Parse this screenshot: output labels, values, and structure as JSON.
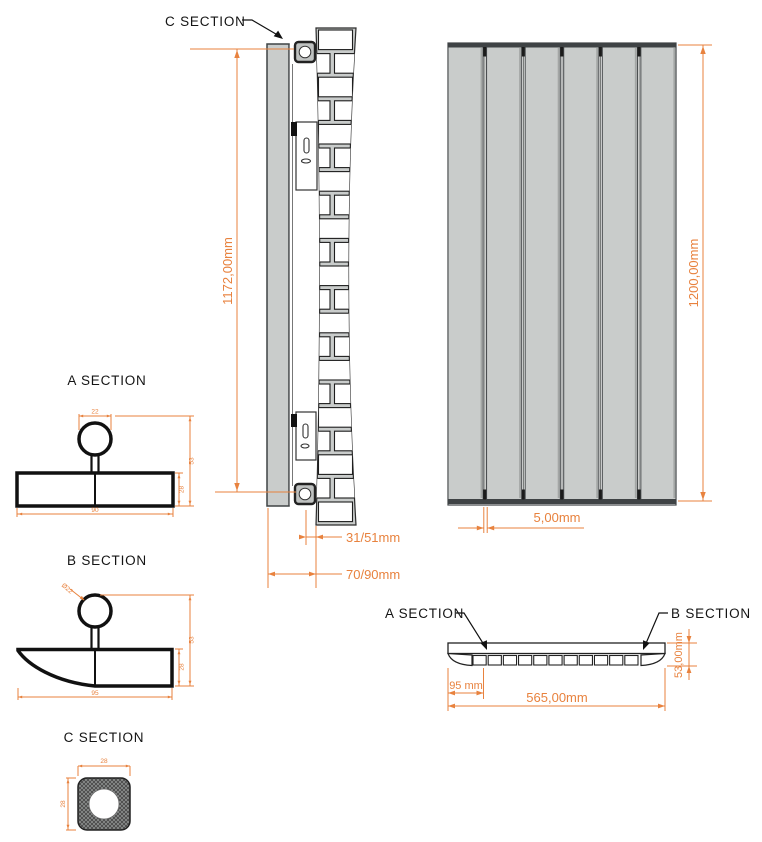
{
  "colors": {
    "dimension": "#E8823E",
    "line": "#1F1F1F",
    "panel_fill": "#C9CCCB",
    "panel_edge": "#3F4345",
    "brick_fill": "#FFFFFF",
    "background": "#FFFFFF"
  },
  "labels": {
    "c_section_callout": "C SECTION",
    "a_section_title": "A SECTION",
    "b_section_title": "B SECTION",
    "c_section_title": "C SECTION",
    "top_view_a_callout": "A SECTION",
    "top_view_b_callout": "B SECTION"
  },
  "dimensions": {
    "side_height": "1172,00mm",
    "tube_to_wall": "31/51mm",
    "panel_to_wall": "70/90mm",
    "front_height": "1200,00mm",
    "panel_gap": "5,00mm",
    "first_section": "95 mm",
    "total_width": "565,00mm",
    "total_depth": "53,00mm"
  },
  "section_dims": {
    "a": {
      "tube_width": "22",
      "total_depth": "53",
      "panel_depth": "28",
      "panel_width": "90"
    },
    "b": {
      "tube_dia": "Ø22",
      "total_depth": "53",
      "panel_depth": "28",
      "panel_width": "95"
    },
    "c": {
      "width": "28",
      "height": "28"
    }
  },
  "front_view": {
    "panel_count": 6
  },
  "top_view": {
    "fin_count": 11
  }
}
